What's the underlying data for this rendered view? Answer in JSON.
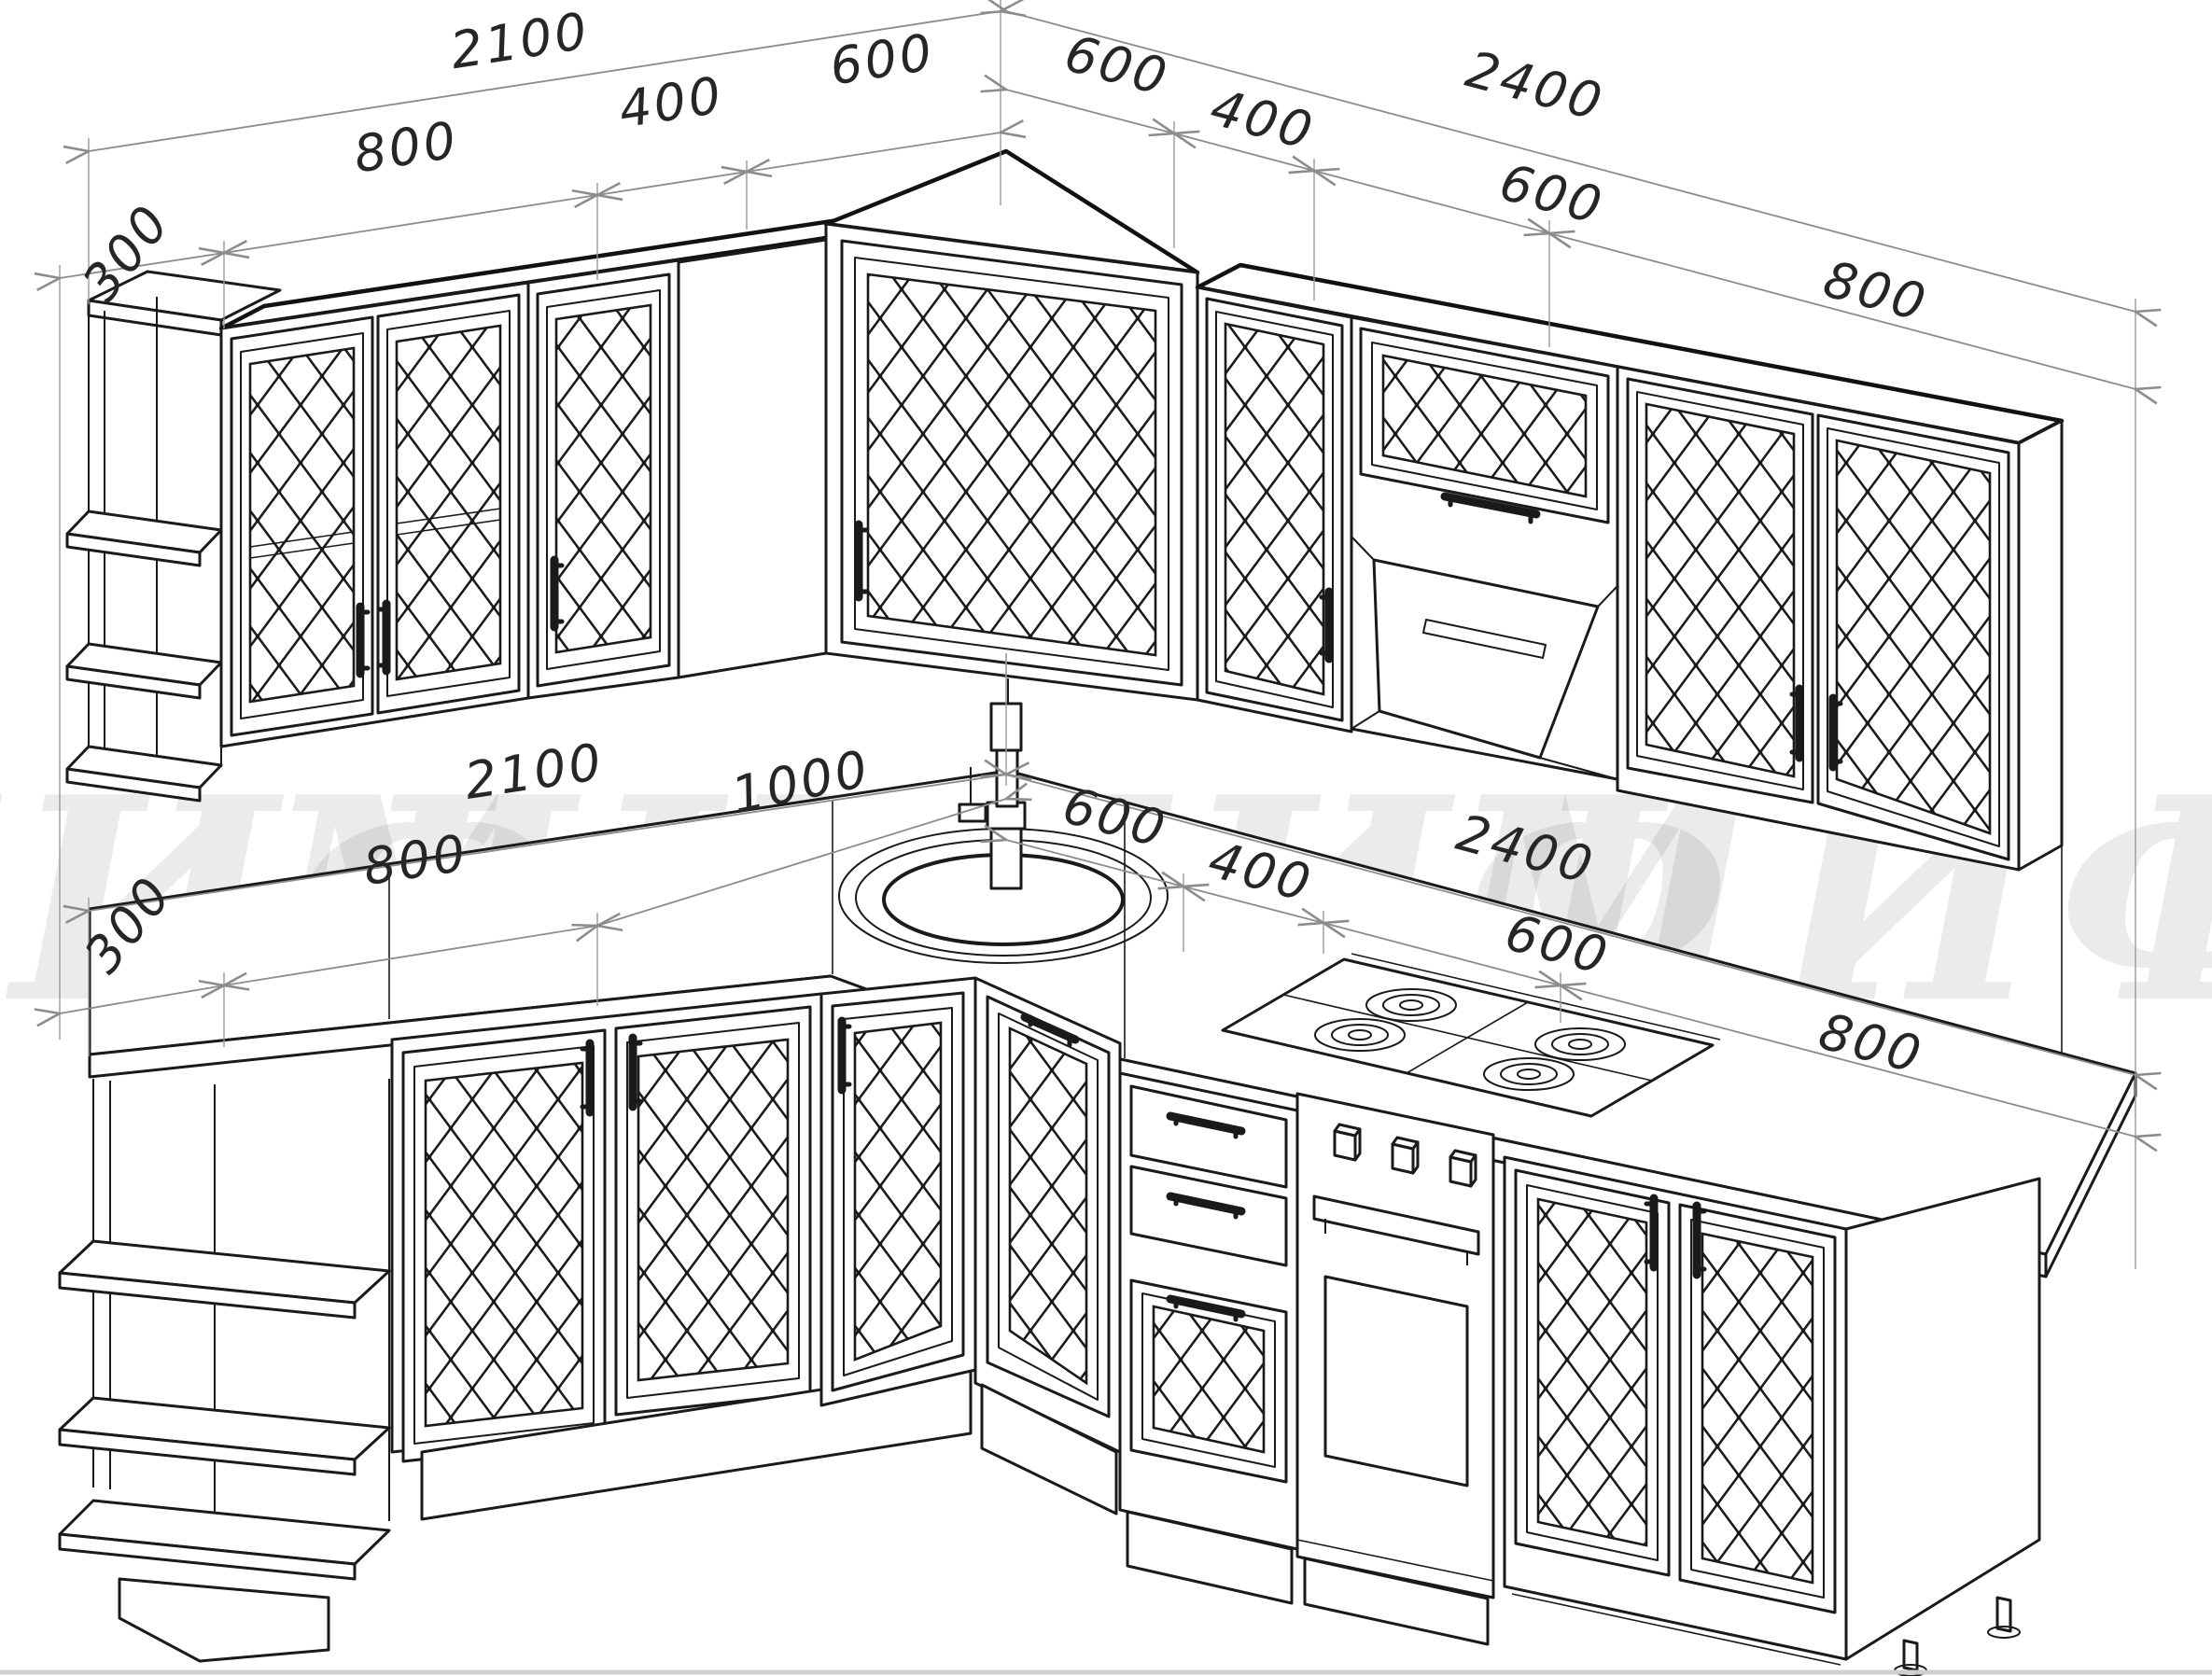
{
  "drawing": {
    "type": "kitchen-corner-set-technical-drawing",
    "watermark": "МИФ",
    "colors": {
      "line": "#1a1a1a",
      "dimension_line": "#8c8c8c",
      "dimension_text": "#262626",
      "background": "#ffffff"
    }
  },
  "dimensions": {
    "upper_left_wall": {
      "total": "2100",
      "segment_800": "800",
      "segment_400": "400",
      "segment_600": "600",
      "end_shelf_depth": "300"
    },
    "upper_right_wall": {
      "total": "2400",
      "segment_600_corner": "600",
      "segment_400": "400",
      "segment_600_hood": "600",
      "segment_800": "800"
    },
    "lower_left_wall": {
      "total": "2100",
      "segment_800": "800",
      "segment_1000": "1000",
      "end_shelf_depth": "300"
    },
    "lower_right_wall": {
      "total": "2400",
      "segment_600_corner": "600",
      "segment_400": "400",
      "segment_600_oven": "600",
      "segment_800": "800"
    }
  }
}
